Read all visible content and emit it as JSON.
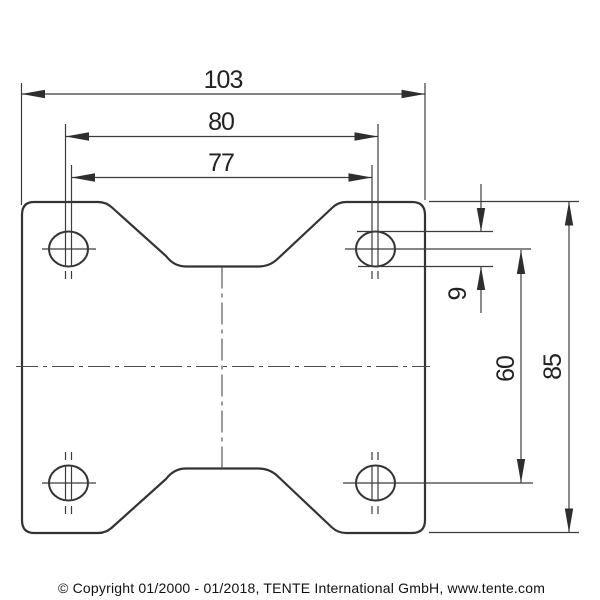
{
  "drawing": {
    "type": "technical-dimension-drawing",
    "background": "#ffffff",
    "line_color": "#333333",
    "dims": {
      "plate_width": "103",
      "hole_pitch_horizontal_outer": "80",
      "hole_pitch_horizontal_inner": "77",
      "hole_slot_width": "9",
      "hole_pitch_vertical": "60",
      "plate_height": "85"
    },
    "footer": "© Copyright 01/2000 - 01/2018, TENTE International GmbH, www.tente.com"
  }
}
